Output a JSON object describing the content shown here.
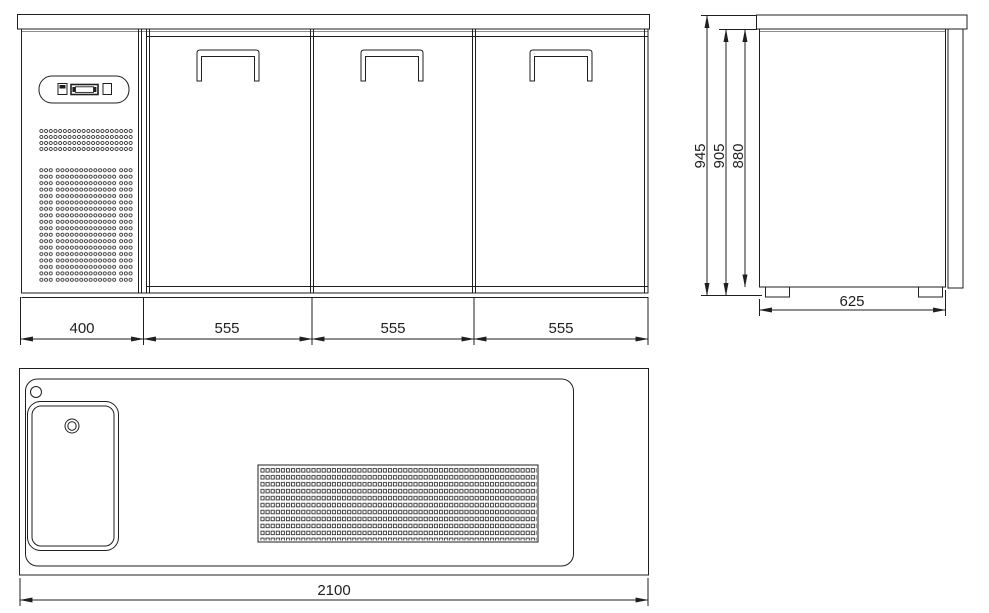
{
  "colors": {
    "line": "#1f1f1f",
    "thin_line": "#333333",
    "shadow_line": "#8c8c8c",
    "background": "#ffffff"
  },
  "views": {
    "front": {
      "label": "front-elevation"
    },
    "side": {
      "label": "side-elevation"
    },
    "top": {
      "label": "plan-view"
    }
  },
  "dims": {
    "front": [
      "400",
      "555",
      "555",
      "555"
    ],
    "side_heights": [
      "945",
      "905",
      "880"
    ],
    "side_depth": "625",
    "top_width": "2100"
  }
}
